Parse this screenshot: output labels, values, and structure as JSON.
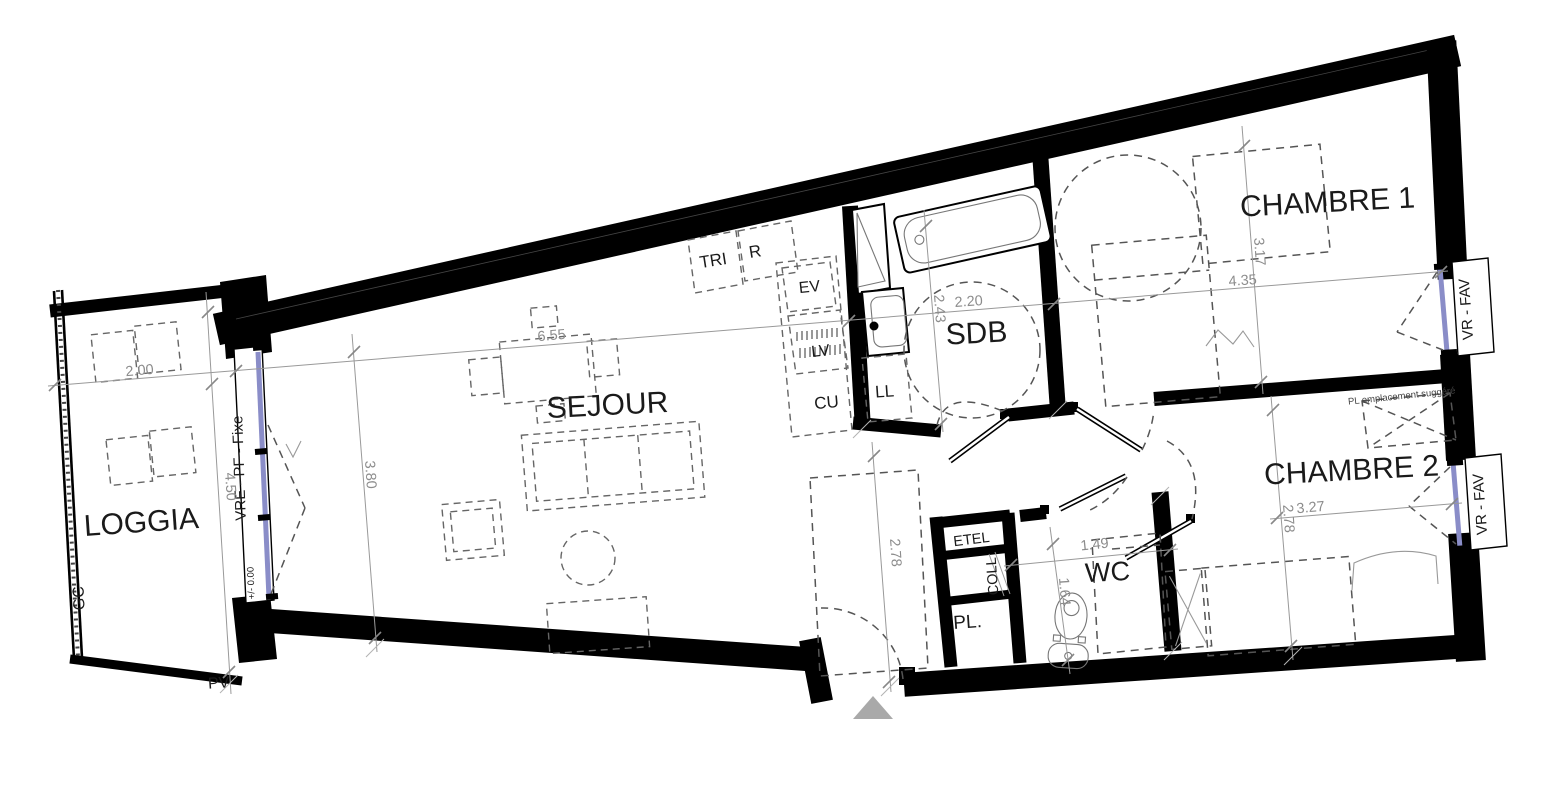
{
  "plan": {
    "labels": {
      "loggia": "LOGGIA",
      "sejour": "SEJOUR",
      "sdb": "SDB",
      "chambre1": "CHAMBRE 1",
      "chambre2": "CHAMBRE 2",
      "wc": "WC",
      "tri": "TRI",
      "r": "R",
      "ev": "EV",
      "lv": "LV",
      "cu": "CU",
      "ll": "LL",
      "etel": "ETEL",
      "coll": "COLL",
      "pl": "PL.",
      "pl_note": "PL emplacement suggéré",
      "gc": "GC",
      "pv": "PV",
      "level": "+/- 0.00",
      "window_fixed": "VRE - PF - Fixe",
      "window_fav1": "VR - FAV",
      "window_fav2": "VR - FAV"
    },
    "dims": {
      "loggia_w": "2.00",
      "loggia_l": "4.50",
      "sejour_l": "6.55",
      "sejour_w": "3.80",
      "sdb_w": "2.20",
      "sdb_l": "2.43",
      "ch1_w": "4.35",
      "ch1_l": "3.17",
      "ch2_w": "3.27",
      "ch2_l": "2.78",
      "entry_l": "2.78",
      "wc_w": "1.49",
      "wc_l": "1.64"
    },
    "colors": {
      "wall": "#000000",
      "glazing": "#8a8dc8",
      "dimension": "#8c8c8c",
      "dashed": "#666666",
      "entrance_arrow": "#a9a9a9"
    }
  }
}
